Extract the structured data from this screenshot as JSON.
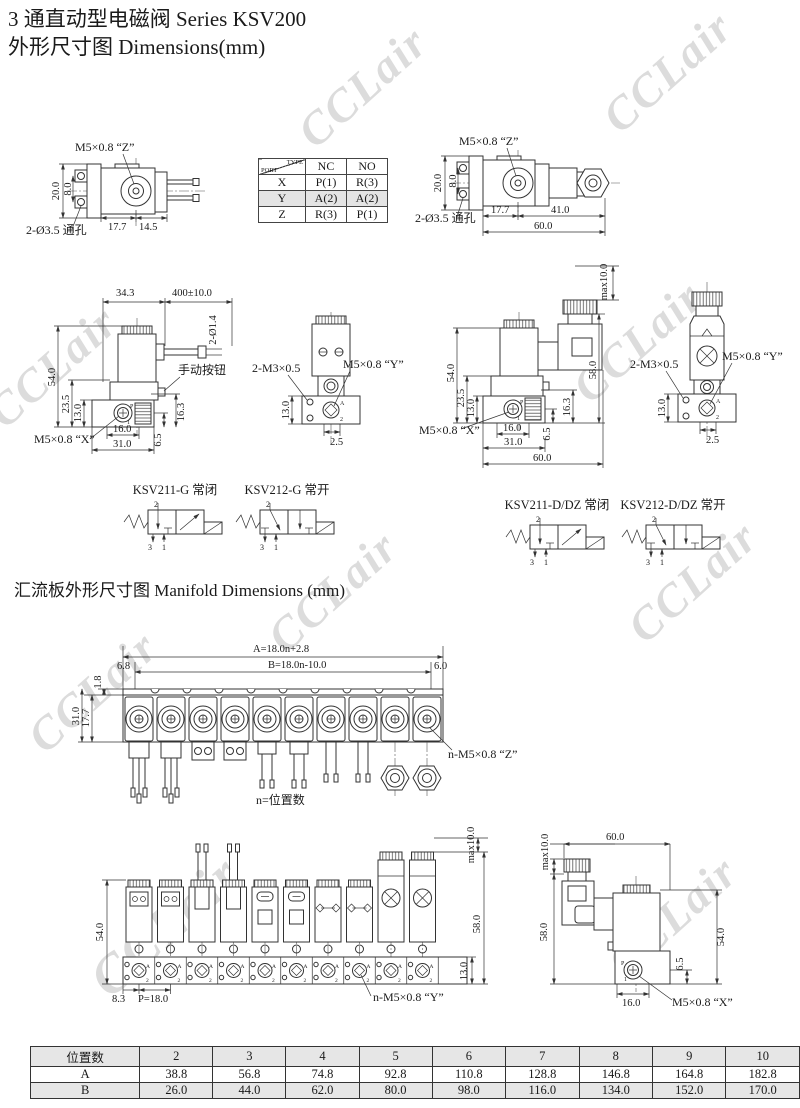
{
  "page": {
    "title_line1": "3 通直动型电磁阀 Series KSV200",
    "title_line2": "外形尺寸图 Dimensions(mm)",
    "watermark_text": "CCLair"
  },
  "port_table": {
    "corner_type": "TYPE",
    "corner_port": "PORT",
    "col_nc": "NC",
    "col_no": "NO",
    "rows": [
      {
        "port": "X",
        "nc": "P(1)",
        "no": "R(3)"
      },
      {
        "port": "Y",
        "nc": "A(2)",
        "no": "A(2)"
      },
      {
        "port": "Z",
        "nc": "R(3)",
        "no": "P(1)"
      }
    ]
  },
  "top_left": {
    "thread": "M5×0.8 “Z”",
    "holes": "2-Ø3.5 通孔",
    "dim_20": "20.0",
    "dim_8": "8.0",
    "dim_177": "17.7",
    "dim_145": "14.5"
  },
  "top_right": {
    "thread": "M5×0.8 “Z”",
    "holes": "2-Ø3.5 通孔",
    "dim_20": "20.0",
    "dim_8": "8.0",
    "dim_177": "17.7",
    "dim_410": "41.0",
    "dim_600": "60.0"
  },
  "g_side": {
    "dim_343": "34.3",
    "dim_cable": "400±10.0",
    "dim_wire": "2-Ø1.4",
    "dim_540": "54.0",
    "dim_235": "23.5",
    "dim_130": "13.0",
    "manual_btn": "手动按钮",
    "thread_x": "M5×0.8 “X”",
    "dim_163": "16.3",
    "dim_65": "6.5",
    "dim_160": "16.0",
    "dim_310": "31.0",
    "port_p": "P",
    "port_1": "1"
  },
  "g_front": {
    "screws": "2-M3×0.5",
    "thread_y": "M5×0.8 “Y”",
    "dim_130": "13.0",
    "dim_25": "2.5",
    "port_a": "A",
    "port_2": "2"
  },
  "d_side": {
    "dim_max": "max10.0",
    "dim_580": "58.0",
    "dim_540": "54.0",
    "dim_235": "23.5",
    "dim_130": "13.0",
    "dim_163": "16.3",
    "dim_65": "6.5",
    "dim_160": "16.0",
    "dim_310": "31.0",
    "dim_600": "60.0",
    "thread_x": "M5×0.8 “X”",
    "port_p": "P",
    "port_1": "1"
  },
  "d_front": {
    "screws": "2-M3×0.5",
    "thread_y": "M5×0.8 “Y”",
    "dim_130": "13.0",
    "dim_25": "2.5",
    "port_a": "A",
    "port_2": "2"
  },
  "symbols": {
    "s1": {
      "label": "KSV211-G 常闭"
    },
    "s2": {
      "label": "KSV212-G 常开"
    },
    "s3": {
      "label": "KSV211-D/DZ 常闭"
    },
    "s4": {
      "label": "KSV212-D/DZ 常开"
    },
    "port_top": "2",
    "port_bl": "3",
    "port_br": "1"
  },
  "manifold": {
    "section_title": "汇流板外形尺寸图 Manifold Dimensions (mm)",
    "top_view": {
      "dim_a": "A=18.0n+2.8",
      "dim_b": "B=18.0n-10.0",
      "dim_68": "6.8",
      "dim_60": "6.0",
      "dim_18": "1.8",
      "dim_177": "17.7",
      "dim_310": "31.0",
      "thread_z": "n-M5×0.8 “Z”",
      "caption": "n=位置数"
    },
    "front_view": {
      "dim_540": "54.0",
      "dim_max": "max10.0",
      "dim_580": "58.0",
      "dim_130": "13.0",
      "dim_83": "8.3",
      "dim_p": "P=18.0",
      "thread_y": "n-M5×0.8 “Y”",
      "port_a": "A",
      "port_2": "2"
    },
    "side_view": {
      "dim_max": "max10.0",
      "dim_600": "60.0",
      "dim_580": "58.0",
      "dim_540": "54.0",
      "dim_65": "6.5",
      "dim_160": "16.0",
      "thread_x": "M5×0.8 “X”",
      "port_p": "P",
      "port_1": "1"
    }
  },
  "size_table": {
    "header_label": "位置数",
    "row_a": "A",
    "row_b": "B",
    "cols": [
      "2",
      "3",
      "4",
      "5",
      "6",
      "7",
      "8",
      "9",
      "10"
    ],
    "a_vals": [
      "38.8",
      "56.8",
      "74.8",
      "92.8",
      "110.8",
      "128.8",
      "146.8",
      "164.8",
      "182.8"
    ],
    "b_vals": [
      "26.0",
      "44.0",
      "62.0",
      "80.0",
      "98.0",
      "116.0",
      "134.0",
      "152.0",
      "170.0"
    ]
  }
}
